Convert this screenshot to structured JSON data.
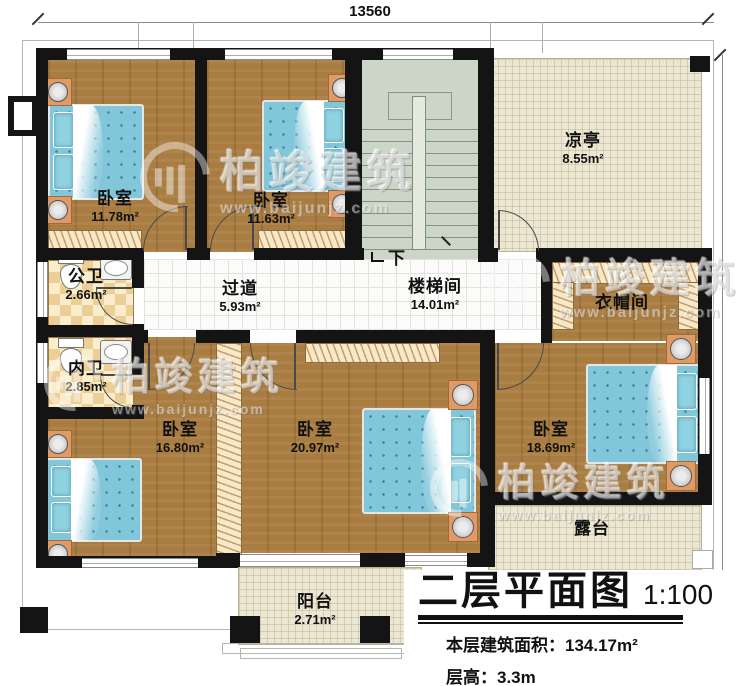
{
  "dimensions": {
    "top_width": "13560",
    "right_height": "11700"
  },
  "rooms": [
    {
      "key": "bedroom-top-left",
      "name": "卧室",
      "area": "11.78m²"
    },
    {
      "key": "bedroom-top-mid",
      "name": "卧室",
      "area": "11.63m²"
    },
    {
      "key": "pavilion",
      "name": "凉亭",
      "area": "8.55m²"
    },
    {
      "key": "public-bathroom",
      "name": "公卫",
      "area": "2.66m²"
    },
    {
      "key": "hallway",
      "name": "过道",
      "area": "5.93m²"
    },
    {
      "key": "stairwell",
      "name": "楼梯间",
      "area": "14.01m²"
    },
    {
      "key": "cloakroom",
      "name": "衣帽间",
      "area": ""
    },
    {
      "key": "private-bathroom",
      "name": "内卫",
      "area": "2.85m²"
    },
    {
      "key": "bedroom-bottom-left",
      "name": "卧室",
      "area": "16.80m²"
    },
    {
      "key": "bedroom-bottom-mid",
      "name": "卧室",
      "area": "20.97m²"
    },
    {
      "key": "bedroom-bottom-right",
      "name": "卧室",
      "area": "18.69m²"
    },
    {
      "key": "terrace",
      "name": "露台",
      "area": ""
    },
    {
      "key": "balcony",
      "name": "阳台",
      "area": "2.71m²"
    }
  ],
  "stairs": {
    "direction_label": "下"
  },
  "title": {
    "main": "二层平面图",
    "scale": "1:100",
    "area_label": "本层建筑面积：",
    "area_value": "134.17m²",
    "height_label": "层高：",
    "height_value": "3.3m"
  },
  "watermark": {
    "brand": "柏竣建筑",
    "url": "www.baijunjz.com"
  },
  "colors": {
    "wall": "#141414",
    "wood_floor": "#a97c41",
    "bed_blue": "#82c6da",
    "stair_green": "#ccd6c8",
    "cream_tile": "#ece7d2",
    "bath_checker": "#ecce97"
  }
}
